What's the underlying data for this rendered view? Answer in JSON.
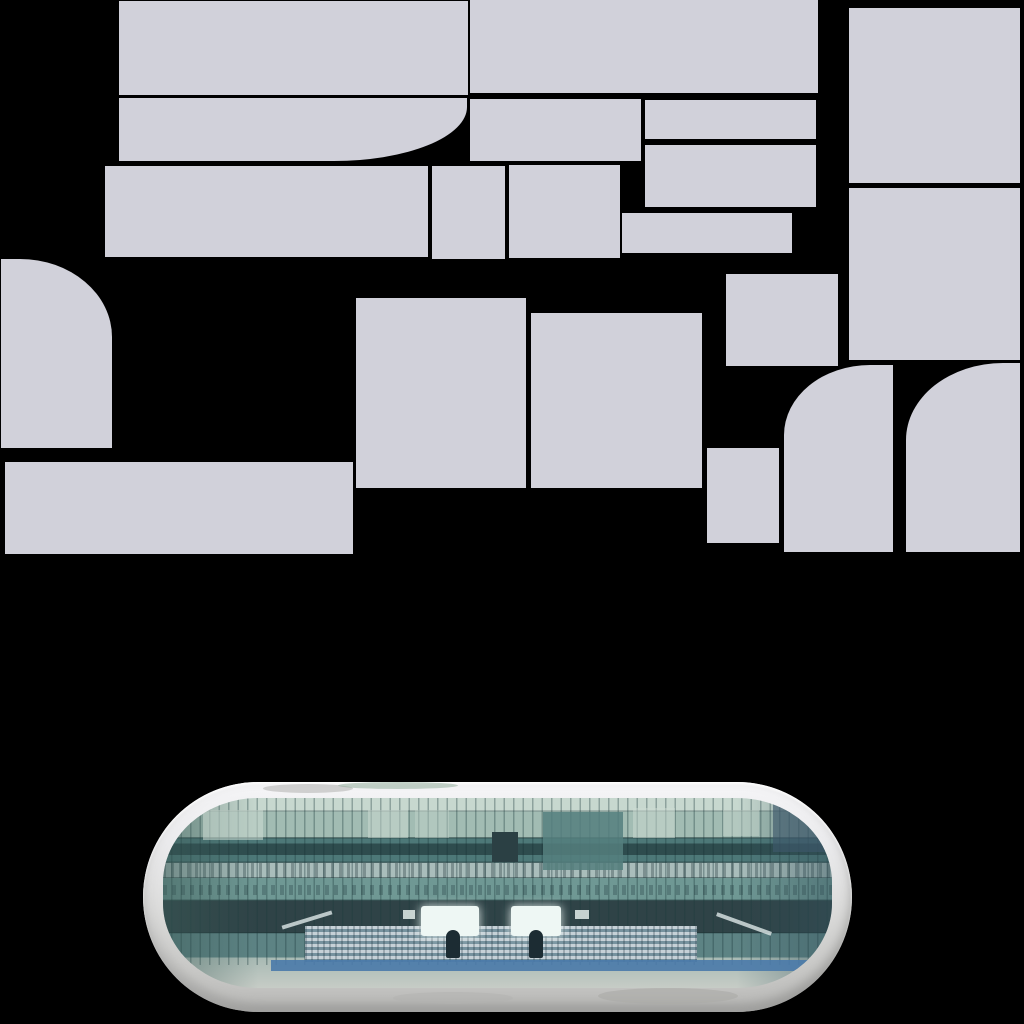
{
  "colors": {
    "bg": "#000000",
    "sprite": "#d1d1da",
    "frame-top": "#f5f5f7",
    "frame-mid": "#dcdcdb",
    "frame-low": "#cacac8",
    "frame-bottom": "#b9b9b7",
    "glass-light": "#c7d8cf",
    "glass-upper": "#a2bcb3",
    "glass-dark": "#4d7878",
    "glass-dotted": "#a9bdbb",
    "glass-mid": "#6f9894",
    "glass-deep": "#2f4347",
    "glass-mid2": "#5d8384",
    "fade-bottom": "#a8bab4",
    "window-dark": "#2b4044",
    "screen-white": "#eef7f4",
    "figure-dark": "#1c2c33",
    "stand-light": "#c6d1d7",
    "stand-dark": "#76929e",
    "stripe-blue": "#4a7aaa",
    "mullion": "rgba(28,58,60,0.4)"
  },
  "atlas": {
    "sprites": [
      {
        "name": "panel-top-left",
        "x": 119,
        "y": 1,
        "w": 349,
        "h": 94
      },
      {
        "name": "panel-top-right",
        "x": 470,
        "y": 0,
        "w": 348,
        "h": 93
      },
      {
        "name": "panel-side-upper",
        "x": 849,
        "y": 8,
        "w": 171,
        "h": 175
      },
      {
        "name": "panel-swoosh",
        "x": 119,
        "y": 98,
        "w": 348,
        "h": 63,
        "br": "0 0 133px 0 / 0 0 54px 0"
      },
      {
        "name": "panel-row2-a",
        "x": 470,
        "y": 99,
        "w": 171,
        "h": 62
      },
      {
        "name": "panel-row2-b",
        "x": 645,
        "y": 100,
        "w": 171,
        "h": 39
      },
      {
        "name": "panel-row2-c",
        "x": 645,
        "y": 145,
        "w": 171,
        "h": 62
      },
      {
        "name": "panel-row3-a",
        "x": 105,
        "y": 166,
        "w": 323,
        "h": 91
      },
      {
        "name": "panel-row3-b",
        "x": 432,
        "y": 166,
        "w": 73,
        "h": 93
      },
      {
        "name": "panel-row3-c",
        "x": 509,
        "y": 165,
        "w": 111,
        "h": 93
      },
      {
        "name": "panel-row3-d",
        "x": 622,
        "y": 213,
        "w": 170,
        "h": 40
      },
      {
        "name": "panel-side-lower",
        "x": 849,
        "y": 188,
        "w": 171,
        "h": 172
      },
      {
        "name": "panel-corner-topright",
        "x": 1,
        "y": 259,
        "w": 111,
        "h": 189,
        "br": "0 92px 0 0 / 0 78px 0 0"
      },
      {
        "name": "panel-mid-small",
        "x": 726,
        "y": 274,
        "w": 112,
        "h": 92
      },
      {
        "name": "panel-mid-a",
        "x": 356,
        "y": 298,
        "w": 170,
        "h": 190
      },
      {
        "name": "panel-mid-b",
        "x": 531,
        "y": 313,
        "w": 171,
        "h": 175
      },
      {
        "name": "panel-bottom-strip",
        "x": 5,
        "y": 462,
        "w": 348,
        "h": 92
      },
      {
        "name": "panel-small-tall",
        "x": 707,
        "y": 448,
        "w": 72,
        "h": 95
      },
      {
        "name": "panel-corner-topleft-a",
        "x": 784,
        "y": 365,
        "w": 109,
        "h": 187,
        "br": "86px 0 0 0 / 70px 0 0 0"
      },
      {
        "name": "panel-corner-topleft-b",
        "x": 906,
        "y": 363,
        "w": 114,
        "h": 189,
        "br": "97px 0 0 0 / 77px 0 0 0"
      }
    ]
  },
  "mirror": {
    "geometry": {
      "x": 143,
      "y": 782,
      "w": 709,
      "h": 230,
      "radius": 115
    },
    "photo_features": [
      {
        "name": "glass-patch",
        "x": 40,
        "y": 12,
        "w": 60,
        "h": 30,
        "bg": "rgba(205,220,211,0.55)"
      },
      {
        "name": "glass-patch",
        "x": 205,
        "y": 12,
        "w": 40,
        "h": 28,
        "bg": "rgba(205,220,211,0.5)"
      },
      {
        "name": "glass-patch",
        "x": 252,
        "y": 12,
        "w": 34,
        "h": 28,
        "bg": "rgba(195,212,203,0.45)"
      },
      {
        "name": "glass-patch",
        "x": 470,
        "y": 10,
        "w": 42,
        "h": 30,
        "bg": "rgba(205,220,211,0.5)"
      },
      {
        "name": "glass-patch",
        "x": 560,
        "y": 12,
        "w": 36,
        "h": 26,
        "bg": "rgba(200,215,206,0.45)"
      },
      {
        "name": "doorway-dark",
        "x": 329,
        "y": 34,
        "w": 26,
        "h": 30,
        "bg": "var(--window-dark)"
      },
      {
        "name": "teal-block",
        "x": 380,
        "y": 14,
        "w": 80,
        "h": 58,
        "bg": "#557f7e",
        "op": 0.85
      },
      {
        "name": "slate-block",
        "x": 610,
        "y": 6,
        "w": 52,
        "h": 48,
        "bg": "#3e586a",
        "op": 0.65
      },
      {
        "name": "screen-left",
        "x": 258,
        "y": 108,
        "w": 58,
        "h": 30,
        "bg": "var(--screen-white)",
        "br": "3px",
        "sh": "0 0 10px rgba(238,247,244,0.9)"
      },
      {
        "name": "screen-right",
        "x": 348,
        "y": 108,
        "w": 50,
        "h": 30,
        "bg": "var(--screen-white)",
        "br": "3px",
        "sh": "0 0 10px rgba(238,247,244,0.9)"
      },
      {
        "name": "screen-fragment",
        "x": 240,
        "y": 112,
        "w": 12,
        "h": 9,
        "bg": "var(--screen-white)",
        "op": 0.8
      },
      {
        "name": "screen-fragment",
        "x": 412,
        "y": 112,
        "w": 14,
        "h": 9,
        "bg": "var(--screen-white)",
        "op": 0.8
      },
      {
        "name": "figure-left",
        "x": 283,
        "y": 132,
        "w": 14,
        "h": 28,
        "bg": "var(--figure-dark)",
        "br": "7px 7px 2px 2px"
      },
      {
        "name": "figure-right",
        "x": 366,
        "y": 132,
        "w": 14,
        "h": 28,
        "bg": "var(--figure-dark)",
        "br": "7px 7px 2px 2px"
      },
      {
        "name": "stripe-blue",
        "x": 108,
        "y": 162,
        "w": 556,
        "h": 11,
        "bg": "var(--stripe-blue)",
        "op": 0.9
      },
      {
        "name": "rail-left",
        "x": 118,
        "y": 120,
        "w": 52,
        "h": 4,
        "bg": "rgba(222,232,232,0.8)",
        "tr": "rotate(-17deg)"
      },
      {
        "name": "rail-right",
        "x": 552,
        "y": 124,
        "w": 58,
        "h": 4,
        "bg": "rgba(222,232,232,0.8)",
        "tr": "rotate(20deg)"
      }
    ],
    "frame_features": [
      {
        "name": "frame-smudge-gray",
        "x": 120,
        "y": 2,
        "w": 90,
        "h": 9,
        "bg": "rgba(176,176,174,0.55)",
        "br": "50%"
      },
      {
        "name": "frame-smudge-green",
        "x": 195,
        "y": 0,
        "w": 120,
        "h": 7,
        "bg": "rgba(140,170,150,0.5)",
        "br": "50%"
      },
      {
        "name": "frame-smudge-bottom",
        "x": 455,
        "y": 206,
        "w": 140,
        "h": 16,
        "bg": "rgba(170,170,167,0.6)",
        "br": "50%"
      },
      {
        "name": "frame-smudge-bottom",
        "x": 250,
        "y": 210,
        "w": 120,
        "h": 12,
        "bg": "rgba(178,178,175,0.5)",
        "br": "50%"
      }
    ]
  }
}
